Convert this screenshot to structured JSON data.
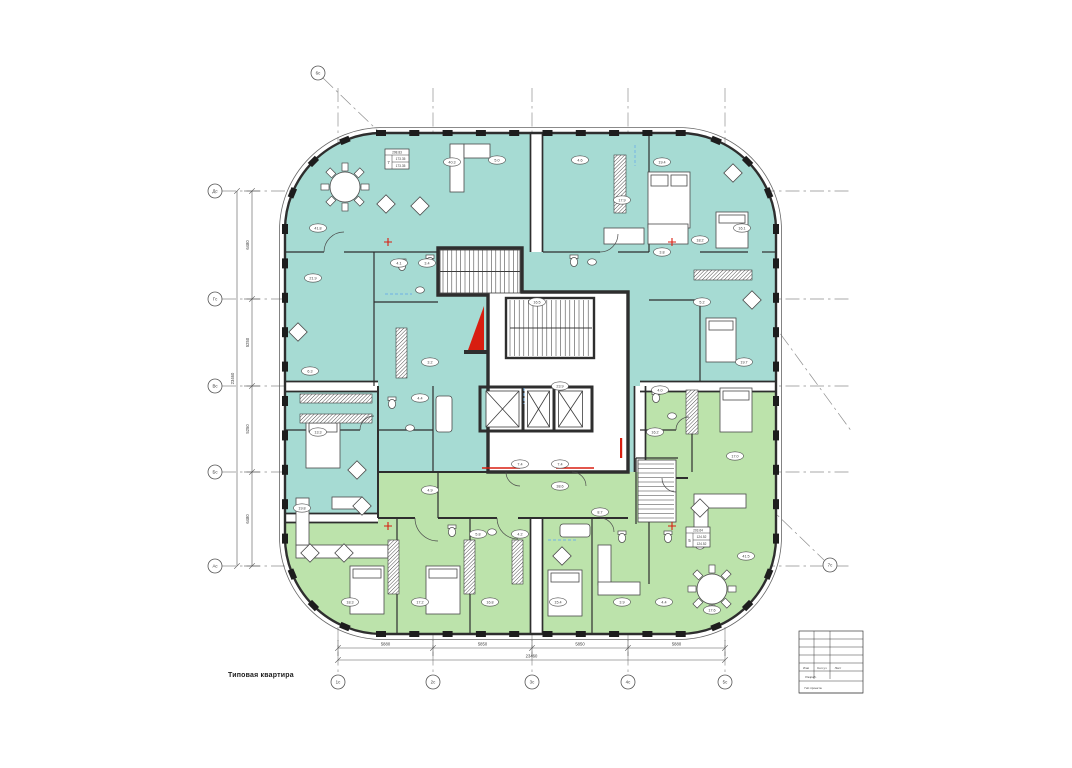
{
  "document": {
    "note_label": "Типовая квартира"
  },
  "colors": {
    "teal": "#a6dbd3",
    "green": "#bce3ab",
    "wall": "#2e2e2e",
    "thin": "#4a4a4a",
    "red": "#d81e10",
    "grid": "#8f8f8f",
    "dim": "#555555",
    "blue": "#6fb0e6"
  },
  "grid": {
    "vertical_axes": [
      {
        "label": "1с",
        "x": 338
      },
      {
        "label": "2с",
        "x": 433
      },
      {
        "label": "3с",
        "x": 532
      },
      {
        "label": "4с",
        "x": 628
      },
      {
        "label": "5с",
        "x": 725
      }
    ],
    "horizontal_axes": [
      {
        "label": "Дс",
        "y": 191
      },
      {
        "label": "Гс",
        "y": 299
      },
      {
        "label": "Вс",
        "y": 386
      },
      {
        "label": "Бс",
        "y": 472
      },
      {
        "label": "Ас",
        "y": 566
      }
    ],
    "corner_axes": [
      {
        "label": "6с",
        "x": 318,
        "y": 73
      },
      {
        "label": "7с",
        "x": 830,
        "y": 565
      }
    ],
    "diagonals": [
      [
        323,
        78,
        824,
        560
      ],
      [
        636,
        136,
        852,
        432
      ]
    ]
  },
  "dimensions": {
    "bottom_segments": [
      {
        "from": 338,
        "to": 433,
        "text": "5880"
      },
      {
        "from": 433,
        "to": 532,
        "text": "5850"
      },
      {
        "from": 532,
        "to": 628,
        "text": "5850"
      },
      {
        "from": 628,
        "to": 725,
        "text": "5880"
      }
    ],
    "bottom_overall": {
      "from": 338,
      "to": 725,
      "text": "23460"
    },
    "left_segments": [
      {
        "from": 191,
        "to": 299,
        "text": "6480"
      },
      {
        "from": 299,
        "to": 386,
        "text": "5250"
      },
      {
        "from": 386,
        "to": 472,
        "text": "5250"
      },
      {
        "from": 472,
        "to": 566,
        "text": "6480"
      }
    ],
    "left_overall": {
      "from": 191,
      "to": 566,
      "text": "23460"
    }
  },
  "apartment_stamps": [
    {
      "x": 385,
      "y": 149,
      "number": "7",
      "area_total": "298.83",
      "area_1": "173.35",
      "area_2": "173.35"
    },
    {
      "x": 686,
      "y": 527,
      "number": "5",
      "area_total": "203.64",
      "area_1": "124.52",
      "area_2": "124.52"
    }
  ],
  "room_labels": [
    {
      "x": 318,
      "y": 228,
      "text": "41.8"
    },
    {
      "x": 313,
      "y": 278,
      "text": "21.9"
    },
    {
      "x": 399,
      "y": 263,
      "text": "4.1"
    },
    {
      "x": 427,
      "y": 263,
      "text": "3.4"
    },
    {
      "x": 310,
      "y": 371,
      "text": "6.3"
    },
    {
      "x": 318,
      "y": 432,
      "text": "13.3"
    },
    {
      "x": 302,
      "y": 508,
      "text": "19.8"
    },
    {
      "x": 452,
      "y": 162,
      "text": "40.3"
    },
    {
      "x": 497,
      "y": 160,
      "text": "5.0"
    },
    {
      "x": 580,
      "y": 160,
      "text": "4.6"
    },
    {
      "x": 622,
      "y": 200,
      "text": "17.9"
    },
    {
      "x": 662,
      "y": 162,
      "text": "19.4"
    },
    {
      "x": 700,
      "y": 240,
      "text": "18.2"
    },
    {
      "x": 662,
      "y": 252,
      "text": "3.8"
    },
    {
      "x": 742,
      "y": 228,
      "text": "16.1"
    },
    {
      "x": 744,
      "y": 362,
      "text": "19.7"
    },
    {
      "x": 702,
      "y": 302,
      "text": "5.2"
    },
    {
      "x": 420,
      "y": 398,
      "text": "4.4"
    },
    {
      "x": 430,
      "y": 362,
      "text": "3.2"
    },
    {
      "x": 537,
      "y": 302,
      "text": "16.5"
    },
    {
      "x": 560,
      "y": 386,
      "text": "23.9"
    },
    {
      "x": 520,
      "y": 464,
      "text": "7.4"
    },
    {
      "x": 560,
      "y": 464,
      "text": "7.4"
    },
    {
      "x": 350,
      "y": 602,
      "text": "18.3"
    },
    {
      "x": 420,
      "y": 602,
      "text": "17.2"
    },
    {
      "x": 490,
      "y": 602,
      "text": "16.8"
    },
    {
      "x": 558,
      "y": 602,
      "text": "15.4"
    },
    {
      "x": 622,
      "y": 602,
      "text": "3.9"
    },
    {
      "x": 664,
      "y": 602,
      "text": "4.4"
    },
    {
      "x": 712,
      "y": 610,
      "text": "17.6"
    },
    {
      "x": 746,
      "y": 556,
      "text": "41.5"
    },
    {
      "x": 600,
      "y": 512,
      "text": "8.7"
    },
    {
      "x": 520,
      "y": 534,
      "text": "4.2"
    },
    {
      "x": 478,
      "y": 534,
      "text": "5.8"
    },
    {
      "x": 560,
      "y": 486,
      "text": "38.6"
    },
    {
      "x": 655,
      "y": 432,
      "text": "16.2"
    },
    {
      "x": 735,
      "y": 456,
      "text": "17.0"
    },
    {
      "x": 660,
      "y": 390,
      "text": "4.0"
    },
    {
      "x": 430,
      "y": 490,
      "text": "4.9"
    }
  ],
  "title_block": {
    "header_cells": [
      "Изм",
      "Кол.уч",
      "Лист"
    ],
    "row_signed": "Разраб.",
    "row_chief": "Гип проекта"
  }
}
